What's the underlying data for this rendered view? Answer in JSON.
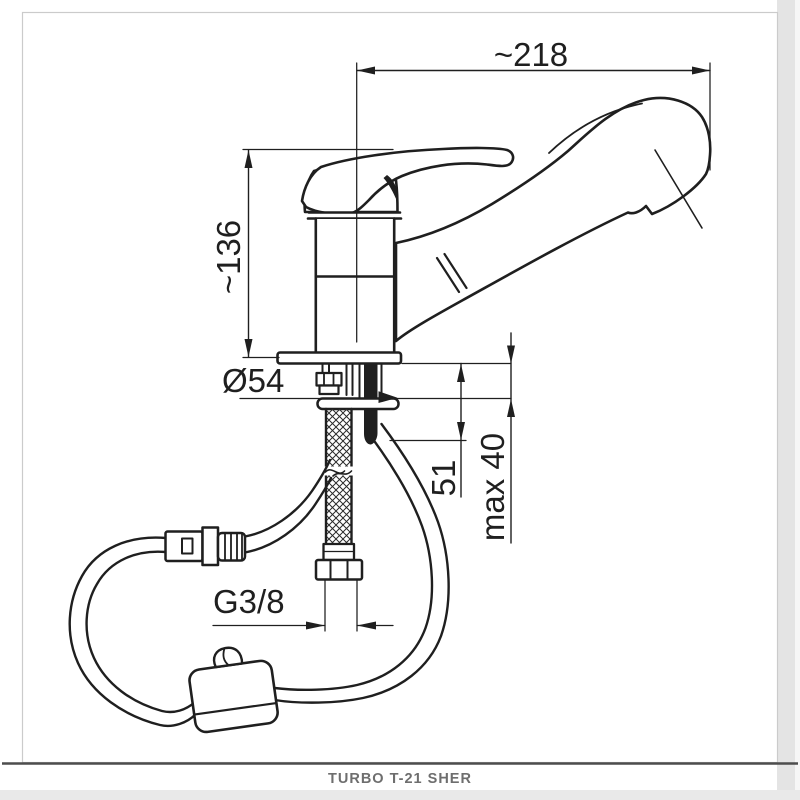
{
  "page": {
    "background": "#ffffff",
    "frame_color": "#cbcbcb",
    "line_color": "#1f1f1f",
    "side_band_color": "#e4e4e4",
    "bottom_band_color": "#e9e9e9"
  },
  "drawing": {
    "dims": {
      "width": {
        "label": "~218"
      },
      "height": {
        "label": "~136"
      },
      "base": {
        "label": "Ø54"
      },
      "shank": {
        "label": "51"
      },
      "counter": {
        "label": "max 40"
      },
      "thread": {
        "label": "G3/8"
      }
    }
  },
  "footer": {
    "caption": "TURBO T-21 SHER",
    "divider_color": "#4d4d4d",
    "text_color": "#6e6e6e"
  }
}
